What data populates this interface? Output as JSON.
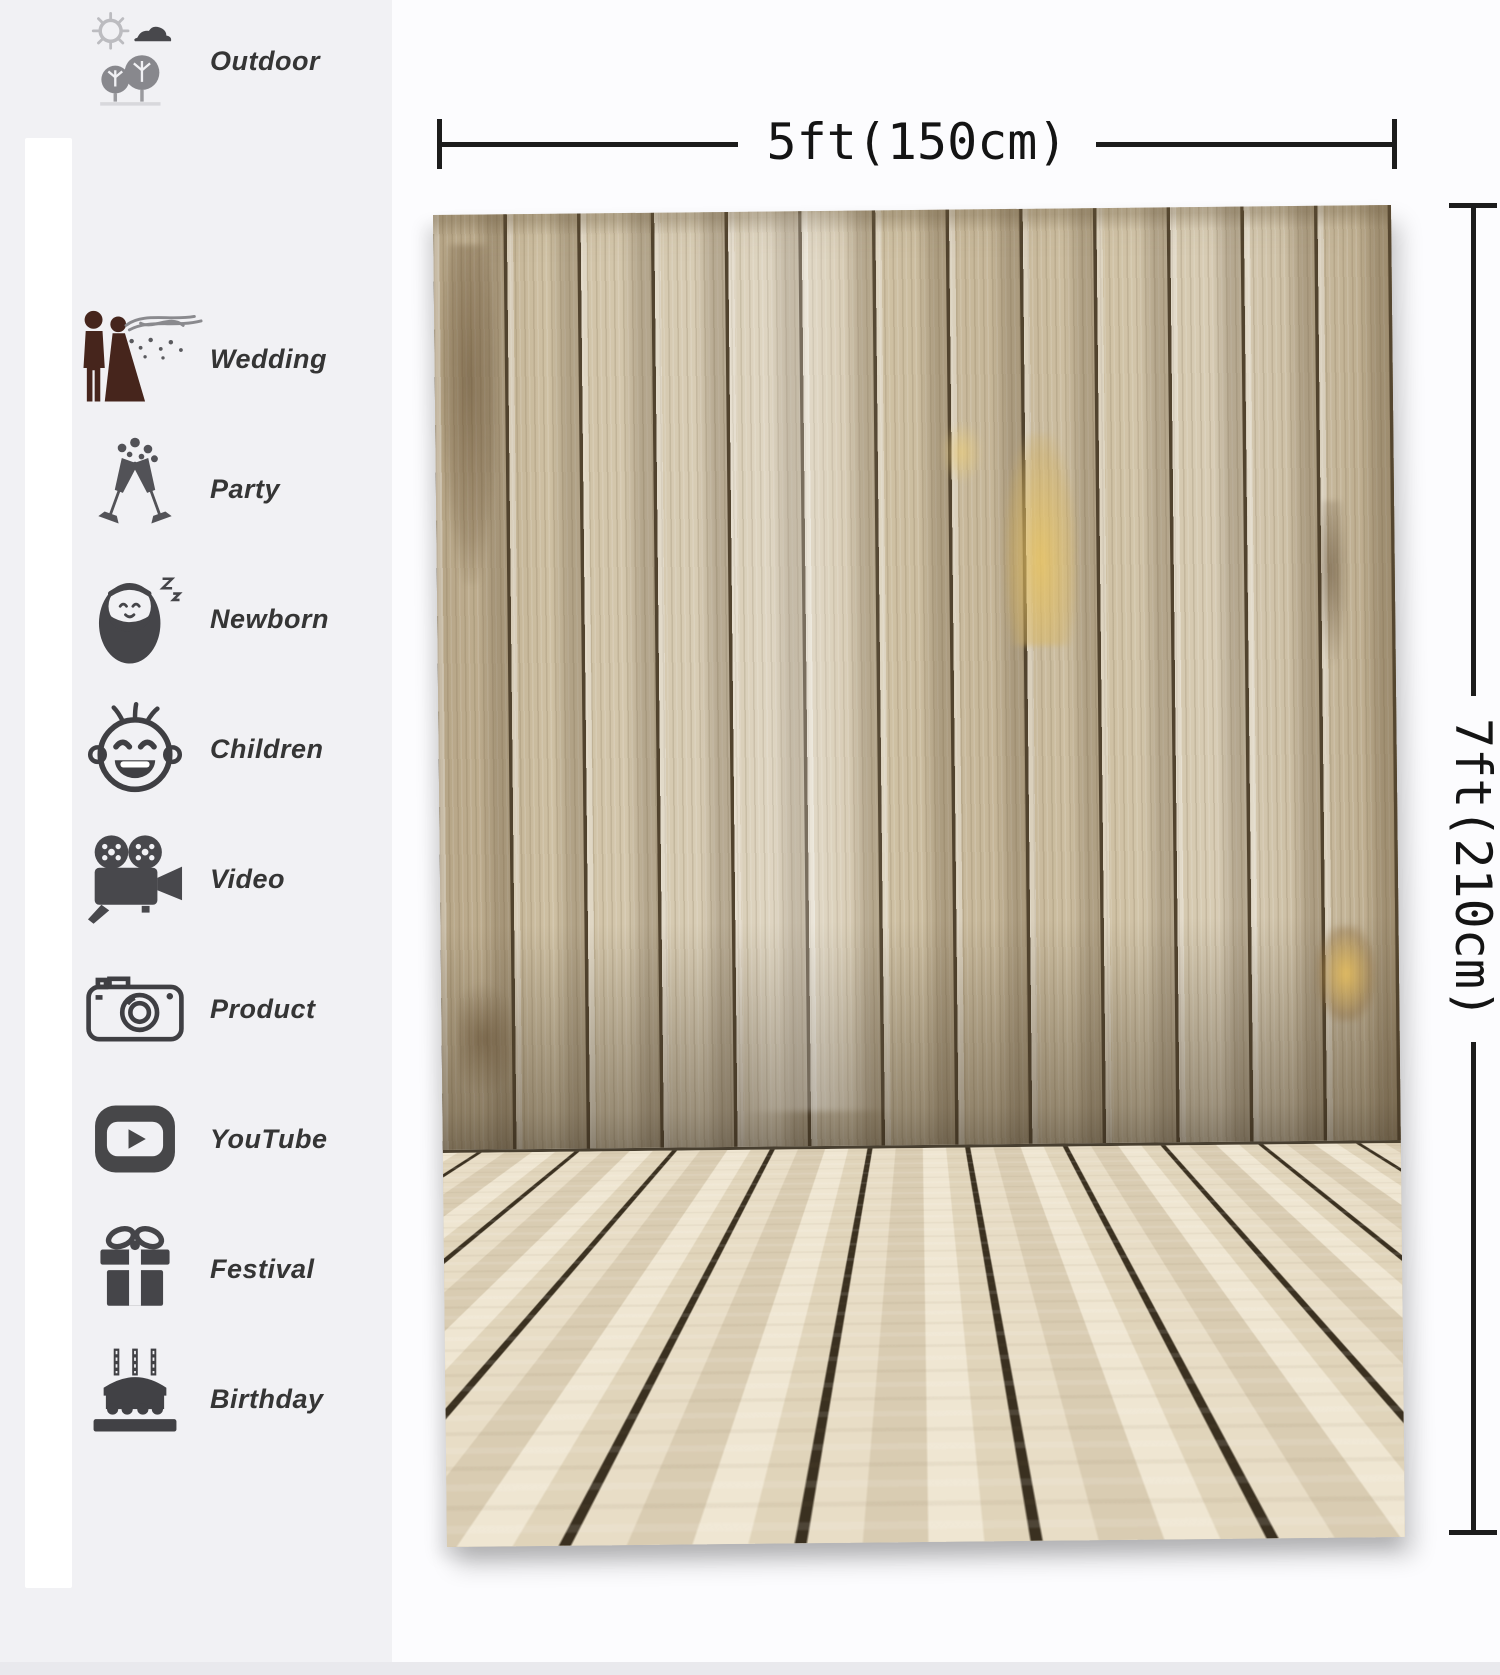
{
  "page": {
    "panel_bg": "#f1f1f4",
    "main_bg": "#fcfcfe",
    "line_color": "#1c1c1c",
    "wood_wall_color": "#cfc1a4",
    "wood_floor_color": "#e4d9c2",
    "wood_seam_color": "#51432e"
  },
  "sidebar": {
    "items": [
      {
        "label": "Wedding",
        "icon": "wedding-couple-icon"
      },
      {
        "label": "Party",
        "icon": "champagne-glasses-icon"
      },
      {
        "label": "Newborn",
        "icon": "swaddled-baby-icon"
      },
      {
        "label": "Children",
        "icon": "baby-face-icon"
      },
      {
        "label": "Video",
        "icon": "movie-camera-icon"
      },
      {
        "label": "Product",
        "icon": "photo-camera-icon"
      },
      {
        "label": "YouTube",
        "icon": "youtube-play-icon"
      },
      {
        "label": "Festival",
        "icon": "gift-box-icon"
      },
      {
        "label": "Birthday",
        "icon": "birthday-cake-icon"
      },
      {
        "label": "Outdoor",
        "icon": "sun-trees-icon"
      }
    ]
  },
  "dimensions": {
    "width_label": "5ft(150cm)",
    "height_label": "7ft(210cm)"
  },
  "backdrop": {
    "subject": "light wood plank backdrop with vertical plank wall and perspective plank floor"
  }
}
